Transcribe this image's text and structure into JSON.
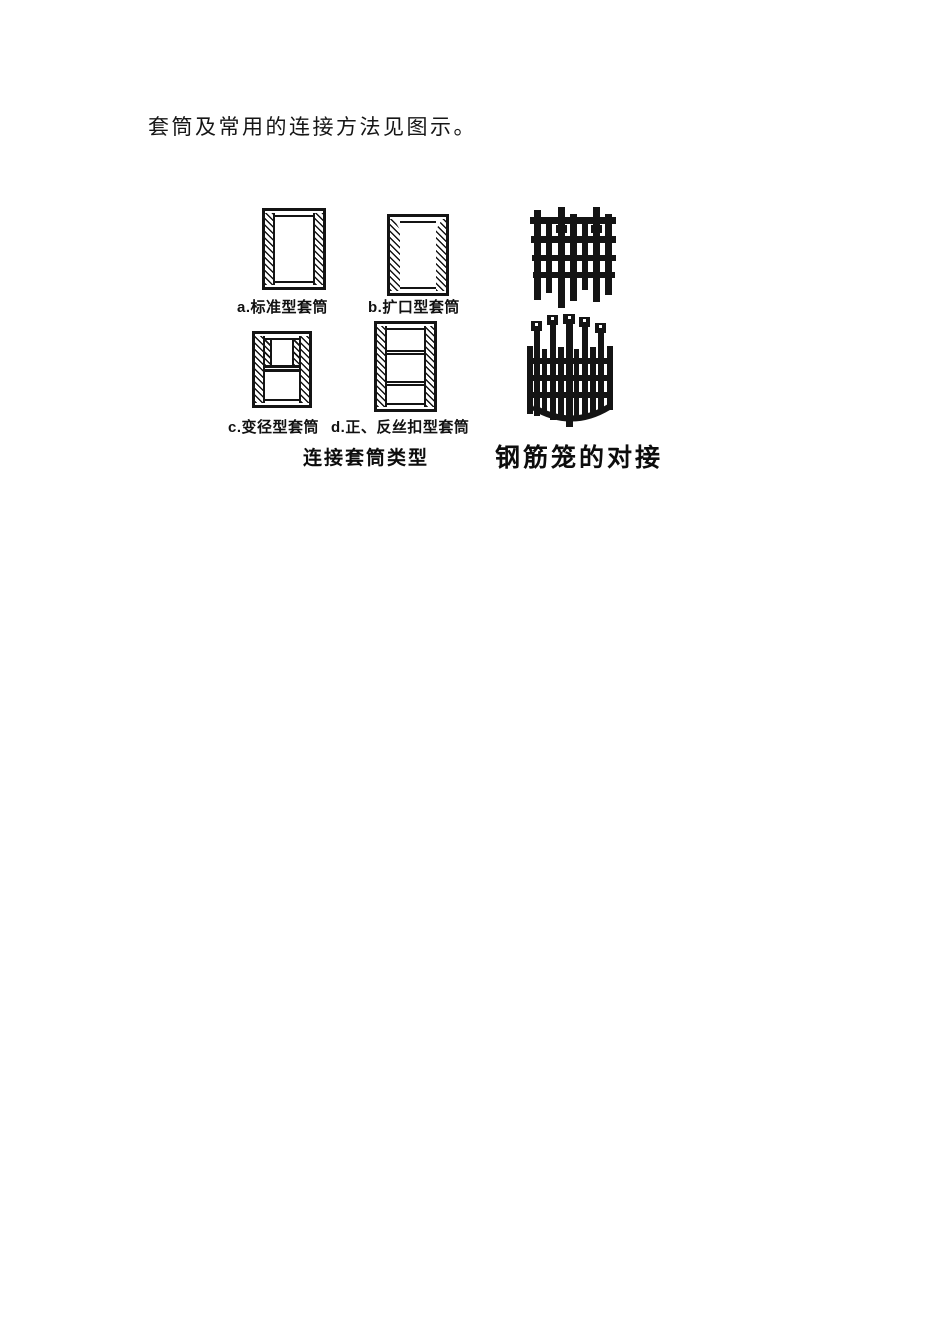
{
  "colors": {
    "ink": "#141414",
    "paper": "#ffffff"
  },
  "intro": {
    "text": "套筒及常用的连接方法见图示。"
  },
  "figure": {
    "sleeves": {
      "a": {
        "label": "a.标准型套筒"
      },
      "b": {
        "label": "b.扩口型套筒"
      },
      "c": {
        "label": "c.变径型套筒"
      },
      "d": {
        "label": "d.正、反丝扣型套筒"
      }
    },
    "captions": {
      "sleeve_types": "连接套筒类型",
      "cage_joint": "钢筋笼的对接"
    },
    "illustrations": {
      "upper_cage": "rebar-cage-upper",
      "lower_cage": "rebar-cage-lower"
    }
  }
}
